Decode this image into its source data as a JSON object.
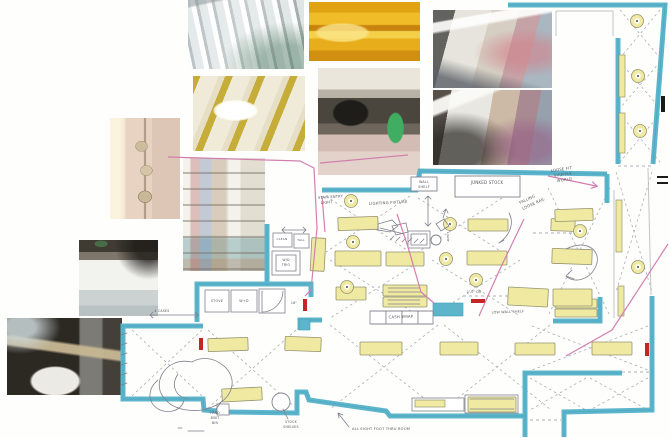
{
  "collage": {
    "photos": [
      {
        "name": "photo-ceiling-pipes"
      },
      {
        "name": "photo-orange-ceiling"
      },
      {
        "name": "photo-store-interior-upper"
      },
      {
        "name": "photo-store-interior-lower"
      },
      {
        "name": "photo-coffered-ceiling"
      },
      {
        "name": "photo-microwave-shelf"
      },
      {
        "name": "photo-wall-electrical-boxes"
      },
      {
        "name": "photo-stock-shelves"
      },
      {
        "name": "photo-white-appliances"
      },
      {
        "name": "photo-basement-laundry"
      }
    ]
  },
  "plan": {
    "colors": {
      "wall": "#5db5cc",
      "wallDark": "#3f9db6",
      "fixture": "#f0e9a2",
      "fixtureEdge": "#94946f",
      "pencil": "#80808c",
      "dash": "#a9adb6",
      "pink": "#d27fae",
      "red": "#c42626",
      "gray": "#c2c4c6",
      "label": "#55555e",
      "black": "#1a1a1a",
      "dot": "#6a6a50"
    },
    "walls": [
      {
        "pts": [
          [
            508,
            5
          ],
          [
            665,
            5
          ],
          [
            653,
            164
          ]
        ]
      },
      {
        "pts": [
          [
            618,
            38
          ],
          [
            618,
            164
          ]
        ]
      },
      {
        "pts": [
          [
            607,
            174
          ],
          [
            420,
            171
          ],
          [
            416,
            190
          ],
          [
            322,
            190
          ]
        ]
      },
      {
        "pts": [
          [
            607,
            174
          ],
          [
            607,
            203
          ]
        ]
      },
      {
        "pts": [
          [
            553,
            321
          ],
          [
            600,
            321
          ],
          [
            600,
            297
          ]
        ]
      },
      {
        "pts": [
          [
            652,
            296
          ],
          [
            652,
            410
          ],
          [
            564,
            412
          ],
          [
            564,
            437
          ]
        ]
      },
      {
        "pts": [
          [
            525,
            437
          ],
          [
            525,
            416
          ],
          [
            390,
            416
          ],
          [
            386,
            411
          ],
          [
            309,
            400
          ],
          [
            306,
            392
          ],
          [
            297,
            392
          ],
          [
            297,
            413
          ],
          [
            228,
            412
          ]
        ]
      },
      {
        "pts": [
          [
            217,
            411
          ],
          [
            204,
            410
          ],
          [
            203,
            399
          ],
          [
            123,
            399
          ],
          [
            123,
            326
          ],
          [
            203,
            326
          ]
        ]
      },
      {
        "pts": [
          [
            525,
            416
          ],
          [
            525,
            373
          ],
          [
            622,
            373
          ]
        ]
      },
      {
        "pts": [
          [
            197,
            322
          ],
          [
            197,
            284
          ],
          [
            311,
            284
          ],
          [
            311,
            297
          ]
        ]
      },
      {
        "pts": [
          [
            267,
            282
          ],
          [
            267,
            224
          ]
        ]
      },
      {
        "pts": [
          [
            300,
            330
          ],
          [
            300,
            320
          ],
          [
            322,
            320
          ]
        ]
      }
    ],
    "tealRects": [
      [
        433,
        303,
        30,
        13
      ],
      [
        299,
        319,
        11,
        11
      ]
    ],
    "grayLines": [
      [
        648,
        168,
        651,
        295
      ],
      [
        614,
        190,
        614,
        318
      ],
      [
        556,
        11,
        613,
        11
      ],
      [
        556,
        11,
        556,
        36
      ],
      [
        613,
        11,
        613,
        36
      ]
    ],
    "dashLines": [
      [
        618,
        166,
        652,
        166
      ],
      [
        463,
        296,
        523,
        296
      ],
      [
        622,
        372,
        652,
        372
      ],
      [
        533,
        233,
        576,
        233
      ],
      [
        530,
        420,
        561,
        420
      ]
    ],
    "xBays": [
      [
        620,
        10,
        40,
        48
      ],
      [
        620,
        62,
        40,
        46
      ],
      [
        620,
        114,
        40,
        48
      ],
      [
        616,
        172,
        36,
        120
      ],
      [
        548,
        188,
        62,
        128
      ],
      [
        326,
        196,
        84,
        56
      ],
      [
        418,
        198,
        84,
        54
      ],
      [
        330,
        260,
        92,
        58
      ],
      [
        432,
        260,
        88,
        56
      ],
      [
        330,
        325,
        108,
        84
      ],
      [
        444,
        325,
        106,
        84
      ],
      [
        132,
        330,
        70,
        66
      ],
      [
        208,
        330,
        88,
        78
      ],
      [
        530,
        378,
        56,
        32
      ],
      [
        590,
        378,
        58,
        32
      ],
      [
        532,
        326,
        116,
        44
      ]
    ],
    "fixtures": [
      [
        338,
        217,
        40,
        13,
        -2
      ],
      [
        468,
        219,
        40,
        12,
        0
      ],
      [
        551,
        219,
        24,
        12,
        2
      ],
      [
        335,
        251,
        46,
        15,
        0
      ],
      [
        386,
        252,
        38,
        14,
        0
      ],
      [
        467,
        251,
        40,
        14,
        0
      ],
      [
        552,
        249,
        40,
        15,
        2
      ],
      [
        555,
        209,
        38,
        12,
        -2
      ],
      [
        555,
        299,
        42,
        9,
        0
      ],
      [
        555,
        309,
        42,
        8,
        0
      ],
      [
        383,
        285,
        44,
        11,
        0
      ],
      [
        383,
        297,
        44,
        10,
        0
      ],
      [
        508,
        288,
        40,
        18,
        3
      ],
      [
        553,
        289,
        39,
        17,
        0
      ],
      [
        336,
        287,
        30,
        13,
        0
      ],
      [
        311,
        238,
        14,
        33,
        3
      ],
      [
        208,
        338,
        40,
        13,
        -2
      ],
      [
        285,
        337,
        36,
        14,
        2
      ],
      [
        360,
        342,
        42,
        13,
        0
      ],
      [
        440,
        342,
        38,
        13,
        0
      ],
      [
        515,
        343,
        40,
        12,
        0
      ],
      [
        592,
        342,
        40,
        13,
        0
      ],
      [
        222,
        388,
        40,
        13,
        -3
      ],
      [
        468,
        397,
        48,
        15,
        0
      ]
    ],
    "strips": [
      [
        619,
        55,
        6,
        42
      ],
      [
        619,
        113,
        6,
        40
      ],
      [
        616,
        200,
        6,
        52
      ],
      [
        618,
        286,
        6,
        30
      ],
      [
        415,
        400,
        30,
        7
      ]
    ],
    "donuts": [
      [
        637,
        21
      ],
      [
        638,
        76
      ],
      [
        640,
        131
      ],
      [
        580,
        231
      ],
      [
        638,
        267
      ],
      [
        351,
        201
      ],
      [
        353,
        242
      ],
      [
        347,
        287
      ],
      [
        450,
        224
      ],
      [
        446,
        259
      ],
      [
        476,
        280
      ]
    ],
    "circles": [
      [
        281,
        402,
        9
      ],
      [
        436,
        240,
        5
      ]
    ],
    "reds": [
      [
        199,
        338,
        4,
        12
      ],
      [
        303,
        299,
        4,
        12
      ],
      [
        471,
        299,
        14,
        4
      ],
      [
        645,
        343,
        4,
        13
      ]
    ],
    "pinks": [
      {
        "pts": [
          [
            168,
            157
          ],
          [
            300,
            161
          ],
          [
            314,
            168
          ],
          [
            317,
            228
          ],
          [
            311,
            290
          ],
          [
            305,
            296
          ]
        ],
        "arrow": false
      },
      {
        "pts": [
          [
            322,
            196
          ],
          [
            325,
            232
          ]
        ],
        "arrow": false
      },
      {
        "pts": [
          [
            397,
            214
          ],
          [
            408,
            247
          ],
          [
            421,
            292
          ],
          [
            434,
            303
          ]
        ],
        "arrow": false
      },
      {
        "pts": [
          [
            524,
            219
          ],
          [
            500,
            269
          ],
          [
            479,
            316
          ]
        ],
        "arrow": false
      },
      {
        "pts": [
          [
            548,
            176
          ],
          [
            596,
            186
          ]
        ],
        "arrow": true
      },
      {
        "pts": [
          [
            668,
            244
          ],
          [
            612,
            330
          ],
          [
            566,
            356
          ]
        ],
        "arrow": false
      },
      {
        "pts": [
          [
            320,
            163
          ],
          [
            408,
            155
          ]
        ],
        "arrow": false
      }
    ],
    "pencilRects": [
      [
        408,
        231,
        22,
        17
      ],
      [
        411,
        234,
        16,
        11
      ],
      [
        205,
        290,
        24,
        22
      ],
      [
        231,
        290,
        26,
        22
      ],
      [
        259,
        289,
        26,
        24
      ],
      [
        273,
        233,
        19,
        14
      ],
      [
        294,
        234,
        15,
        14
      ],
      [
        272,
        251,
        28,
        24
      ],
      [
        276,
        255,
        20,
        16
      ],
      [
        370,
        311,
        16,
        13
      ],
      [
        386,
        311,
        16,
        13
      ],
      [
        402,
        311,
        16,
        13
      ],
      [
        418,
        311,
        15,
        13
      ],
      [
        412,
        398,
        52,
        13
      ],
      [
        465,
        395,
        53,
        18
      ],
      [
        217,
        404,
        12,
        11
      ]
    ],
    "labelBoxes": [
      [
        411,
        177,
        26,
        14
      ],
      [
        455,
        176,
        65,
        21
      ]
    ],
    "pencilPaths": [
      "M192,362 C164,356 150,386 166,400 C174,410 196,414 212,407 C232,399 238,381 226,368 C214,356 200,357 192,362 Z M178,374 C170,386 176,398 190,399",
      "M158,380 C146,390 148,404 160,410 C170,414 182,410 184,400",
      "M566,249 C588,238 602,252 596,266 C590,280 574,284 566,276 M566,276 L572,270 M566,276 L574,279",
      "M378,224 L392,220 L398,226 L390,232 L378,230 Z M392,226 L406,223 L408,232 L396,235 Z M380,228 L404,234",
      "M509,213 C515,224 509,236 499,243 M499,243 L504,240",
      "M436,224 L444,219 L449,226 L441,231 Z M443,218 L446,209 M446,209 L443,212 M446,209 L448,213",
      "M390,240 L394,236 M396,241 L400,237 M402,242 L406,238 M408,242 L412,238 M414,243 L418,239 M420,243 L424,239",
      "M428,196 L428,226 M425,199 L428,196 L431,199 M425,223 L428,226 L431,223",
      "M282,230 L306,230 M285,227 L282,230 L285,233 M303,227 L306,230 L303,233",
      "M150,315 L198,315 M153,312 L150,315 L153,318 M195,312 L198,315 L195,318",
      "M349,427 L338,413 M338,413 L339,418 M338,413 L343,415",
      "M216,409 L222,401 M288,419 L283,409",
      "M262,291 L262,312 A21,21 0 0 0 283,291",
      "M371,311 L433,311 M371,324 L433,324",
      "M388,288 L420,288 M388,292 L420,292 M388,300 L420,300 M388,304 L420,304",
      "M121,335 L127,333 M121,345 L127,343 M121,355 L127,353 M121,365 L127,363 M121,375 L127,373 M121,385 L127,383",
      "M188,431 L204,431 M178,428 L182,428",
      "M459,190 L514,190 M459,194 L505,194",
      "M470,399 L514,399 M470,409 L514,409"
    ],
    "labels": [
      {
        "x": 318,
        "y": 199,
        "t": "STAIR ENTRY",
        "s": 3.6,
        "r": -4,
        "a": "start"
      },
      {
        "x": 321,
        "y": 204,
        "t": "LIGHT",
        "s": 3.6,
        "r": -4,
        "a": "start"
      },
      {
        "x": 369,
        "y": 205,
        "t": "LIGHTING FIXTURE",
        "s": 3.8,
        "r": -3,
        "a": "start"
      },
      {
        "x": 424,
        "y": 183,
        "t": "WALL",
        "s": 3.4,
        "r": 0,
        "a": "middle"
      },
      {
        "x": 424,
        "y": 188,
        "t": "SHELF",
        "s": 3.4,
        "r": 0,
        "a": "middle"
      },
      {
        "x": 487,
        "y": 184,
        "t": "JUNKED STOCK",
        "s": 4,
        "r": 0,
        "a": "middle"
      },
      {
        "x": 551,
        "y": 172,
        "t": "LOOSE FIT",
        "s": 3.8,
        "r": -8,
        "a": "start"
      },
      {
        "x": 554,
        "y": 177,
        "t": "SHUFFLE",
        "s": 3.8,
        "r": -8,
        "a": "start"
      },
      {
        "x": 557,
        "y": 182,
        "t": "WORLD",
        "s": 3.8,
        "r": -8,
        "a": "start"
      },
      {
        "x": 520,
        "y": 204,
        "t": "FALLING",
        "s": 3.8,
        "r": -25,
        "a": "start"
      },
      {
        "x": 523,
        "y": 210,
        "t": "LOOSE RAIL",
        "s": 3.8,
        "r": -25,
        "a": "start"
      },
      {
        "x": 282,
        "y": 240,
        "t": "CLEAN",
        "s": 3,
        "r": 0,
        "a": "middle"
      },
      {
        "x": 301,
        "y": 241,
        "t": "TALL",
        "s": 3,
        "r": 0,
        "a": "middle"
      },
      {
        "x": 286,
        "y": 261,
        "t": "W/D",
        "s": 3.2,
        "r": 0,
        "a": "middle"
      },
      {
        "x": 286,
        "y": 266,
        "t": "TRIO",
        "s": 3.2,
        "r": 0,
        "a": "middle"
      },
      {
        "x": 217,
        "y": 302,
        "t": "STOVE",
        "s": 3.4,
        "r": 0,
        "a": "middle"
      },
      {
        "x": 244,
        "y": 302,
        "t": "W+D",
        "s": 3.4,
        "r": 0,
        "a": "middle"
      },
      {
        "x": 401,
        "y": 318,
        "t": "CASH WRAP",
        "s": 3.8,
        "r": -2,
        "a": "middle"
      },
      {
        "x": 508,
        "y": 313,
        "t": "LOW WALL SHELF",
        "s": 3.4,
        "r": -2,
        "a": "middle"
      },
      {
        "x": 474,
        "y": 293,
        "t": "2'-0\" DR",
        "s": 3.2,
        "r": 0,
        "a": "middle"
      },
      {
        "x": 297,
        "y": 304,
        "t": "18\"",
        "s": 3.2,
        "r": 0,
        "a": "end"
      },
      {
        "x": 215,
        "y": 414,
        "t": "FRND",
        "s": 3.2,
        "r": 0,
        "a": "middle"
      },
      {
        "x": 215,
        "y": 419,
        "t": "BSKT",
        "s": 3.2,
        "r": 0,
        "a": "middle"
      },
      {
        "x": 215,
        "y": 424,
        "t": "BIN",
        "s": 3.2,
        "r": 0,
        "a": "middle"
      },
      {
        "x": 291,
        "y": 423,
        "t": "STOCK",
        "s": 3.2,
        "r": 0,
        "a": "middle"
      },
      {
        "x": 291,
        "y": 428,
        "t": "SHELVES",
        "s": 3.2,
        "r": 0,
        "a": "middle"
      },
      {
        "x": 352,
        "y": 430,
        "t": "ALL EIGHT FOOT THRU ROOM",
        "s": 3.6,
        "r": 0,
        "a": "start"
      },
      {
        "x": 162,
        "y": 312,
        "t": "4 CASES",
        "s": 3.2,
        "r": 0,
        "a": "middle"
      },
      {
        "x": 447,
        "y": 237,
        "t": "LIGHT",
        "s": 3,
        "r": 90,
        "a": "middle"
      }
    ],
    "blacks": [
      [
        661,
        96,
        4,
        16
      ],
      [
        657,
        176,
        11,
        2
      ],
      [
        657,
        182,
        11,
        2
      ]
    ]
  }
}
